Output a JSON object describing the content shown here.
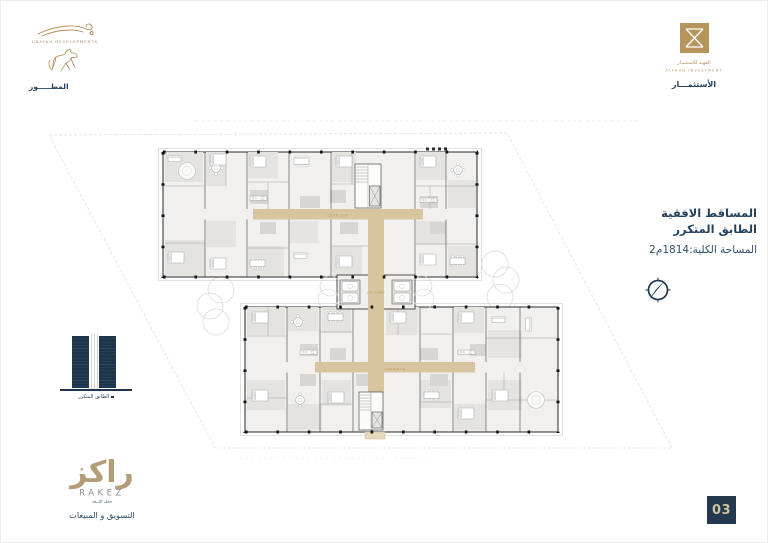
{
  "page": {
    "number": "03"
  },
  "developer": {
    "company_en": "UBAYAH DEVELOPMENTS",
    "role_label": "المطـــــور"
  },
  "investor": {
    "company_ar": "الفهـد للاستثمـار",
    "company_en": "ALFAHD INVESTMENT",
    "role_label": "الأستثمـــار"
  },
  "plan_info": {
    "title": "المساقط الافقية",
    "subtitle": "الطابق المتكرر",
    "area": "المساحة الكلية:1814م2"
  },
  "elevation_key": {
    "caption": "الطابق المتكرر"
  },
  "sales": {
    "brand_ar": "راكز",
    "brand_en": "RAKEZ",
    "tagline": "محل الثــقة",
    "dept": "التسويق و المبيعات"
  },
  "floor_plan": {
    "corridor_label": "CORRIDOR",
    "lobby_label": "LIFT LOBBY",
    "colors": {
      "corridor": "#d8c5a0",
      "walls": "#3c3c3c",
      "rooms": "#f1f0ee",
      "accent_gold": "#b9924f",
      "navy": "#24425c",
      "brand_gold": "#b08d57"
    }
  }
}
